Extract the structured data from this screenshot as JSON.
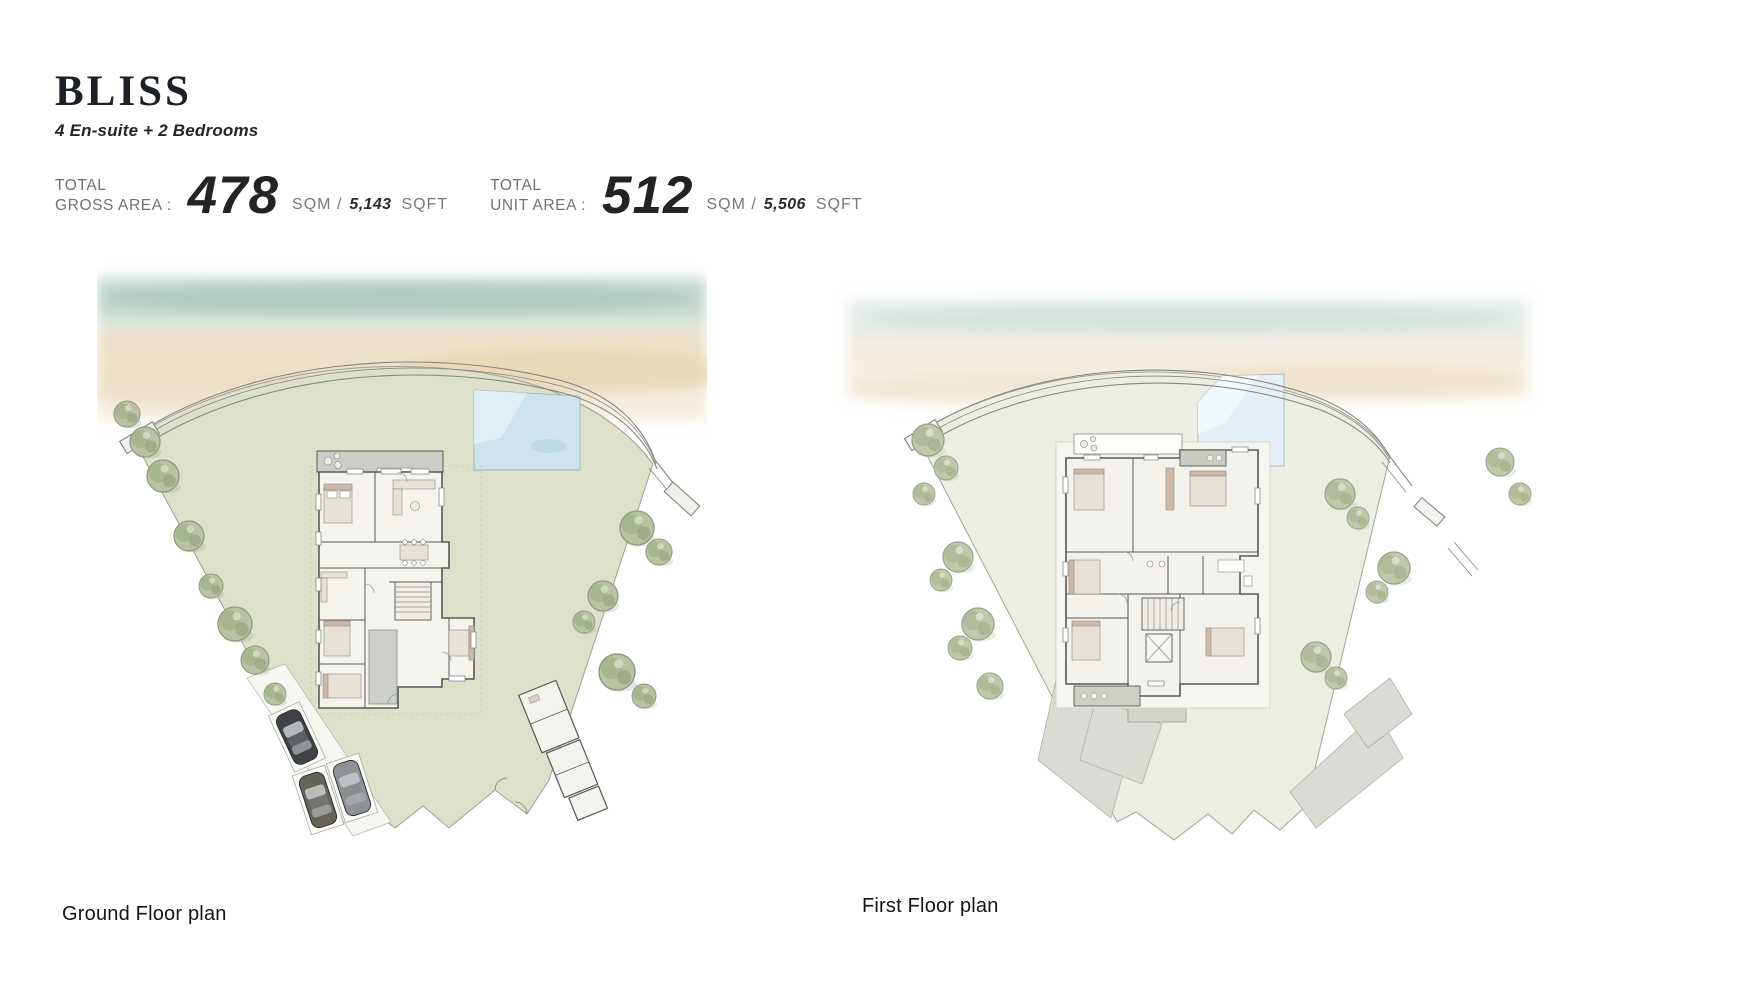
{
  "page": {
    "title": "BLISS",
    "subtitle": "4 En-suite + 2 Bedrooms"
  },
  "stats": [
    {
      "label_line1": "TOTAL",
      "label_line2": "GROSS AREA :",
      "value": "478",
      "unit_prefix": "SQM /",
      "unit_value": "5,143",
      "unit_suffix": "SQFT"
    },
    {
      "label_line1": "TOTAL",
      "label_line2": "UNIT AREA :",
      "value": "512",
      "unit_prefix": "SQM /",
      "unit_value": "5,506",
      "unit_suffix": "SQFT"
    }
  ],
  "plans": [
    {
      "caption": "Ground Floor plan"
    },
    {
      "caption": "First Floor plan"
    }
  ],
  "palette": {
    "lawn": "#dde1c9",
    "beach_sand": "#ecdcc0",
    "beach_water": "#a9c6bc",
    "pool_ground": "#cfe3ef",
    "pool_first": "#e4eff6",
    "tree": "#b9c3a4",
    "walls": "#56595b",
    "first_floor_ground": "#ecede3",
    "roof_terrace": "#d9dbd4",
    "terrace": "#cbcec6",
    "car_dark": "#3f4346",
    "car_olive": "#66635a",
    "car_gray": "#8f9294"
  }
}
